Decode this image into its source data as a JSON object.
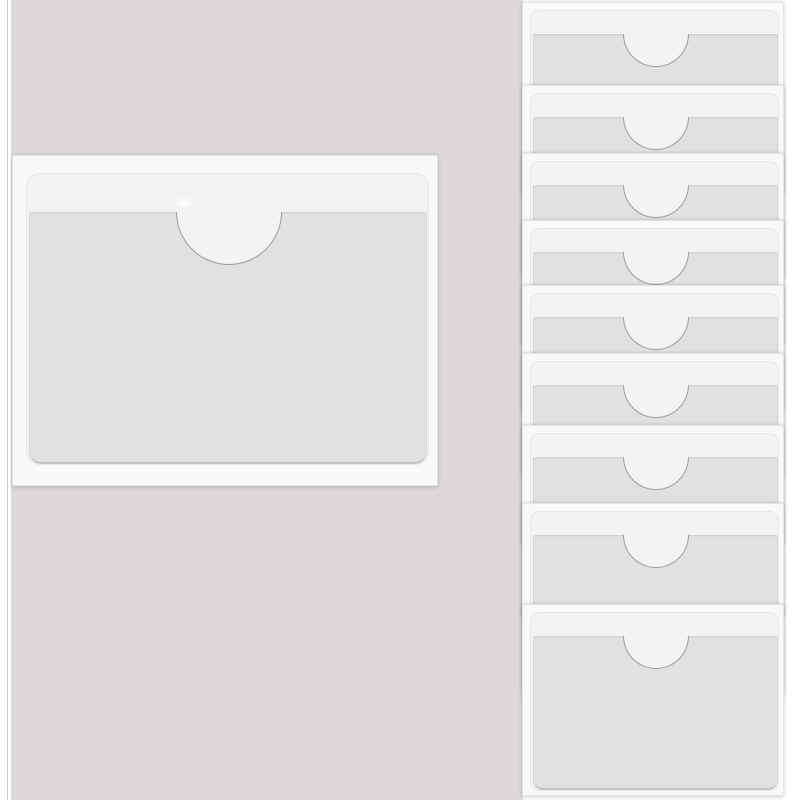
{
  "scene": {
    "subject": "self-adhesive clear index-card pockets with half-moon thumb notch",
    "pocket_count_total": 10,
    "colors": {
      "page_white": "#FFFFFF",
      "backdrop_gray": "#DDD9D8",
      "margin_line": "#CBC7C6",
      "sleeve_white": "#F9F9F9",
      "sleeve_border": "#E7E5E4",
      "liner_strip": "#F4F3F2",
      "liner_border": "#E9E7E6",
      "pocket_front": "#E2E1E0",
      "front_top_line": "#D2D0CF",
      "front_side_line": "#D9D7D6",
      "front_bottom_line": "#C6C4C3",
      "notch_stroke": "#9E9C9B"
    },
    "left_margin": {
      "width": 11,
      "line_x": 7
    },
    "backdrop": {
      "x": 11,
      "width": 512
    },
    "left_pocket": {
      "x": 12,
      "y": 155,
      "width": 426,
      "height": 331,
      "liner": {
        "left": 13,
        "top": 17,
        "right": 10,
        "bottom": 22,
        "radius": 14
      },
      "strip_height": 38,
      "front_inset": {
        "left": 2,
        "right": 3,
        "bottom": 2,
        "bottom_radius": 12,
        "top_radius": 3
      },
      "notch_radius": 53,
      "highlight_speck": {
        "x": 176,
        "y": 199,
        "width": 16,
        "height": 7
      }
    },
    "right_stack": {
      "count": 9,
      "x": 522,
      "width": 262,
      "pocket_height": 192,
      "tops": [
        2,
        85,
        153,
        220,
        285,
        353,
        425,
        503,
        604
      ],
      "liner": {
        "left": 7,
        "top": 7,
        "right": 6,
        "bottom": 6,
        "radius": 9
      },
      "strip_height": 23,
      "front_inset": {
        "left": 2,
        "right": 2,
        "bottom": 2,
        "bottom_radius": 10,
        "top_radius": 2
      },
      "notch_radius": 33
    }
  }
}
